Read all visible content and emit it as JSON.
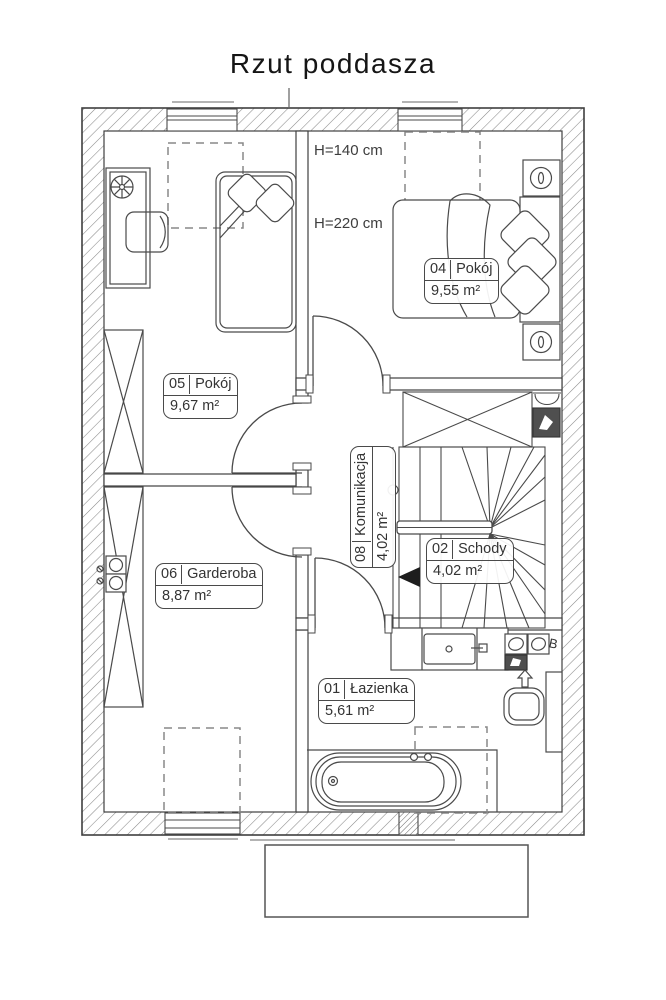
{
  "title": "Rzut poddasza",
  "rooms": [
    {
      "number": "01",
      "name": "Łazienka",
      "area": "5,61 m²"
    },
    {
      "number": "02",
      "name": "Schody",
      "area": "4,02 m²"
    },
    {
      "number": "04",
      "name": "Pokój",
      "area": "9,55 m²"
    },
    {
      "number": "05",
      "name": "Pokój",
      "area": "9,67 m²"
    },
    {
      "number": "06",
      "name": "Garderoba",
      "area": "8,87 m²"
    },
    {
      "number": "08",
      "name": "Komunikacja",
      "area": "4,02 m²"
    }
  ],
  "annotations": {
    "height_knee_wall": "H=140 cm",
    "height_main": "H=220 cm",
    "boiler_mark": "B"
  },
  "icons": {
    "stairs-direction-arrow": "◀",
    "exhaust-arrow-up": "⇧",
    "bedside-lamp": "Φ",
    "desk-fan": "✳",
    "wardrobe-cross": "✕"
  },
  "colors": {
    "line": "#4a4a4a",
    "hatch": "#8a8a8a",
    "dark_fixture": "#4f4f4f",
    "dashed": "#888888",
    "background": "#ffffff"
  }
}
